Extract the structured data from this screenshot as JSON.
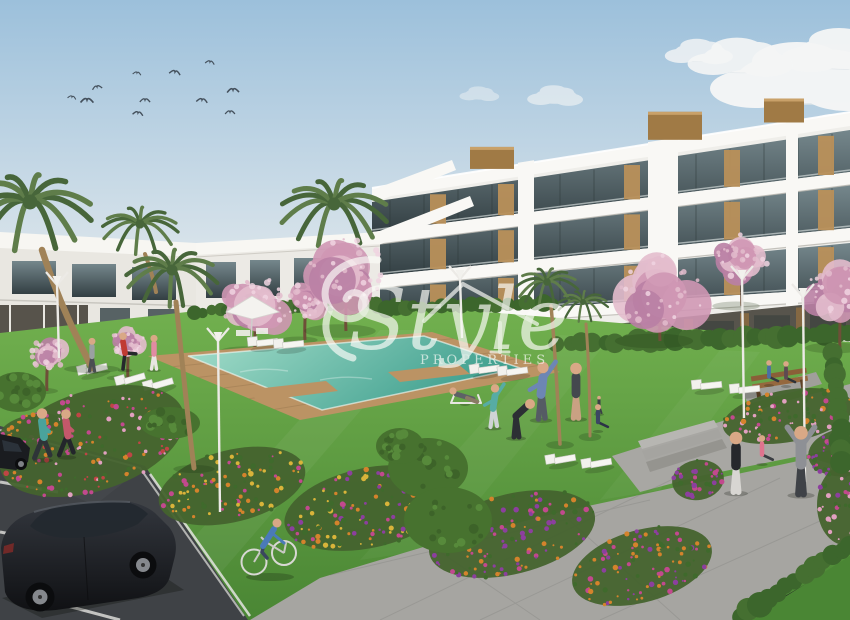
{
  "meta": {
    "kind": "3D architectural render photograph",
    "subject": "New-build residential apartment complex with communal pool, lawns, flower beds and parking"
  },
  "watermark": {
    "brand_script": "Style",
    "brand_sub": "PROPERTIES"
  },
  "colors": {
    "sky_top": "#9cc0db",
    "sky_horizon": "#e4eaed",
    "cloud": "#f5f6f6",
    "wall_white": "#efeeea",
    "wall_bright": "#f9f8f5",
    "wall_shade": "#dddbd4",
    "glass_top": "#75878c",
    "glass_bottom": "#333f43",
    "wood": "#b9905a",
    "wood_dark": "#a07a45",
    "blossom_a": "#cf97b4",
    "blossom_b": "#e3bccd",
    "blossom_c": "#b97fa4",
    "palm_a": "#5f7d4a",
    "palm_b": "#47663a",
    "trunk": "#a08257",
    "lawn": "#72b14f",
    "lawn_dark": "#4a8634",
    "hedge": "#3c662c",
    "bed_base": "#44632e",
    "shrub": "#47722f",
    "flower_orange": "#d4832c",
    "flower_pink": "#c2498e",
    "flower_lightpink": "#e1a0c0",
    "flower_purple": "#8c3f9e",
    "flower_yellow": "#d9b43a",
    "flower_red": "#bf4545",
    "pool_light": "#a5decb",
    "pool_deep": "#3f9f8e",
    "deck": "#bb9364",
    "asphalt": "#3f4246",
    "pavement": "#a6a5a1",
    "pavement_light": "#b5b4b0",
    "line_white": "#e2e2de",
    "car_body": "#17191d",
    "skin": "#d9a886",
    "lamp_white": "#eceae6",
    "watermark": "rgba(251,251,248,0.8)"
  },
  "scene": {
    "birds": [
      [
        210,
        62
      ],
      [
        175,
        72
      ],
      [
        137,
        73
      ],
      [
        97,
        87
      ],
      [
        72,
        97
      ],
      [
        87,
        100
      ],
      [
        145,
        100
      ],
      [
        202,
        100
      ],
      [
        233,
        90
      ],
      [
        138,
        113
      ],
      [
        230,
        112
      ]
    ],
    "clouds": [
      {
        "x": 806,
        "y": 78,
        "s": 1.5,
        "o": 0.97
      },
      {
        "x": 845,
        "y": 52,
        "s": 1.0,
        "o": 0.95
      },
      {
        "x": 742,
        "y": 58,
        "s": 0.85,
        "o": 0.9
      },
      {
        "x": 700,
        "y": 52,
        "s": 0.55,
        "o": 0.8
      },
      {
        "x": 660,
        "y": 173,
        "s": 0.6,
        "o": 0.85
      },
      {
        "x": 722,
        "y": 153,
        "s": 0.45,
        "o": 0.8
      },
      {
        "x": 624,
        "y": 180,
        "s": 0.4,
        "o": 0.75
      },
      {
        "x": 556,
        "y": 96,
        "s": 0.45,
        "o": 0.6
      },
      {
        "x": 838,
        "y": 132,
        "s": 0.75,
        "o": 0.9
      },
      {
        "x": 480,
        "y": 94,
        "s": 0.32,
        "o": 0.45
      }
    ],
    "right_building": {
      "x0": 372,
      "x1": 850,
      "roofL": 188,
      "roofR": 112,
      "bands": [
        {
          "tL": 202,
          "tR": 130,
          "hL": 30,
          "hR": 42
        },
        {
          "tL": 245,
          "tR": 185,
          "hL": 31,
          "hR": 43
        },
        {
          "tL": 289,
          "tR": 243,
          "hL": 29,
          "hR": 45
        }
      ],
      "slabs": [
        {
          "tL": 232,
          "tR": 172,
          "h": 13
        },
        {
          "tL": 276,
          "tR": 228,
          "h": 13
        },
        {
          "tL": 318,
          "tR": 288,
          "h": 12
        }
      ],
      "piers": [
        {
          "x": 518,
          "w": 16
        },
        {
          "x": 648,
          "w": 30
        },
        {
          "x": 786,
          "w": 12
        }
      ],
      "wood": [
        430,
        498,
        624,
        724,
        818
      ],
      "roofBoxes": [
        {
          "x": 470,
          "w": 44,
          "h": 22
        },
        {
          "x": 648,
          "w": 54,
          "h": 28
        },
        {
          "x": 764,
          "w": 40,
          "h": 24
        }
      ]
    },
    "palms_back": [
      {
        "cx": 334,
        "cy": 204,
        "r": 54,
        "trunk": "M 337,246 C 343,268 350,286 353,300",
        "w": 5
      },
      {
        "cx": 140,
        "cy": 224,
        "r": 38,
        "trunk": "M 145,254 C 150,268 154,280 156,292",
        "w": 4
      }
    ],
    "palms_front": [
      {
        "cx": 30,
        "cy": 202,
        "r": 62,
        "trunk": "M 42,250 C 58,300 76,336 92,368",
        "w": 6.5,
        "bx": 92,
        "by": 369
      },
      {
        "cx": 172,
        "cy": 270,
        "r": 46,
        "trunk": "M 176,302 C 182,360 188,422 194,468",
        "w": 5,
        "bx": 194,
        "by": 469
      },
      {
        "cx": 547,
        "cy": 282,
        "r": 31,
        "trunk": "M 551,306 C 556,358 558,408 560,444",
        "w": 3.5,
        "bx": 560,
        "by": 445
      },
      {
        "cx": 583,
        "cy": 302,
        "r": 25,
        "trunk": "M 586,324 C 589,364 590,402 590,436",
        "w": 3,
        "bx": 590,
        "by": 437
      }
    ],
    "blossoms": [
      {
        "cx": 255,
        "cy": 306,
        "r": 36,
        "gy": 352
      },
      {
        "cx": 305,
        "cy": 300,
        "r": 22,
        "gy": 340
      },
      {
        "cx": 346,
        "cy": 271,
        "r": 42,
        "gy": 331
      },
      {
        "cx": 660,
        "cy": 291,
        "r": 46,
        "gy": 341
      },
      {
        "cx": 742,
        "cy": 257,
        "r": 28,
        "gy": 306
      },
      {
        "cx": 840,
        "cy": 291,
        "r": 34,
        "gy": 348
      },
      {
        "cx": 47,
        "cy": 355,
        "r": 20,
        "gy": 391
      },
      {
        "cx": 128,
        "cy": 342,
        "r": 18,
        "gy": 378
      }
    ],
    "hedges": [
      {
        "x1": 196,
        "y1": 312,
        "x2": 378,
        "y2": 302,
        "r": 6,
        "n": 24
      },
      {
        "x1": 376,
        "y1": 308,
        "x2": 554,
        "y2": 303,
        "r": 7,
        "n": 20
      },
      {
        "x1": 558,
        "y1": 344,
        "x2": 848,
        "y2": 334,
        "r": 9,
        "n": 26
      }
    ],
    "hedges2": [
      {
        "x1": 740,
        "y1": 616,
        "x2": 850,
        "y2": 544,
        "r": 10,
        "n": 13
      },
      {
        "x1": 833,
        "y1": 354,
        "x2": 843,
        "y2": 462,
        "r": 9,
        "n": 11
      }
    ],
    "beds": [
      {
        "cx": 92,
        "cy": 441,
        "rx": 96,
        "ry": 50,
        "rot": -18,
        "n": 150,
        "pal": [
          "flower_pink",
          "flower_lightpink",
          "flower_red",
          "flower_orange"
        ]
      },
      {
        "cx": 30,
        "cy": 427,
        "rx": 30,
        "ry": 12,
        "rot": -14,
        "n": 26,
        "pal": [
          "flower_orange",
          "flower_pink"
        ]
      },
      {
        "cx": 232,
        "cy": 486,
        "rx": 75,
        "ry": 36,
        "rot": -14,
        "n": 100,
        "pal": [
          "flower_orange",
          "flower_pink",
          "flower_yellow"
        ]
      },
      {
        "cx": 368,
        "cy": 508,
        "rx": 85,
        "ry": 40,
        "rot": -12,
        "n": 120,
        "pal": [
          "flower_orange",
          "flower_pink",
          "flower_purple",
          "flower_yellow"
        ]
      },
      {
        "cx": 512,
        "cy": 534,
        "rx": 85,
        "ry": 40,
        "rot": -14,
        "n": 120,
        "pal": [
          "flower_pink",
          "flower_orange",
          "flower_purple"
        ]
      },
      {
        "cx": 642,
        "cy": 566,
        "rx": 72,
        "ry": 36,
        "rot": -16,
        "n": 100,
        "pal": [
          "flower_purple",
          "flower_pink",
          "flower_orange"
        ]
      },
      {
        "cx": 788,
        "cy": 416,
        "rx": 66,
        "ry": 26,
        "rot": -10,
        "n": 80,
        "pal": [
          "flower_pink",
          "flower_orange",
          "flower_lightpink"
        ]
      },
      {
        "cx": 846,
        "cy": 452,
        "rx": 38,
        "ry": 24,
        "rot": -8,
        "n": 45,
        "pal": [
          "flower_pink",
          "flower_purple"
        ]
      },
      {
        "cx": 845,
        "cy": 505,
        "rx": 28,
        "ry": 40,
        "rot": 0,
        "n": 45,
        "pal": [
          "flower_lightpink",
          "flower_pink",
          "flower_purple"
        ]
      },
      {
        "cx": 698,
        "cy": 480,
        "rx": 26,
        "ry": 20,
        "rot": -10,
        "n": 30,
        "pal": [
          "flower_pink",
          "flower_purple"
        ]
      }
    ],
    "shrubs": [
      {
        "cx": 428,
        "cy": 468,
        "rx": 40,
        "ry": 30
      },
      {
        "cx": 448,
        "cy": 520,
        "rx": 44,
        "ry": 33
      },
      {
        "cx": 400,
        "cy": 446,
        "rx": 24,
        "ry": 18
      },
      {
        "cx": 18,
        "cy": 392,
        "rx": 28,
        "ry": 20
      },
      {
        "cx": 170,
        "cy": 423,
        "rx": 30,
        "ry": 16
      }
    ],
    "loungers": [
      {
        "x": 92,
        "y": 372,
        "rot": -14
      },
      {
        "x": 130,
        "y": 382,
        "rot": -16
      },
      {
        "x": 158,
        "y": 387,
        "rot": -16
      },
      {
        "x": 262,
        "y": 345,
        "rot": -6
      },
      {
        "x": 288,
        "y": 347,
        "rot": -6
      },
      {
        "x": 484,
        "y": 372,
        "rot": -8
      },
      {
        "x": 512,
        "y": 374,
        "rot": -8
      },
      {
        "x": 560,
        "y": 462,
        "rot": -10
      },
      {
        "x": 596,
        "y": 466,
        "rot": -10
      },
      {
        "x": 706,
        "y": 388,
        "rot": -6
      },
      {
        "x": 744,
        "y": 392,
        "rot": -6
      }
    ],
    "lamps": [
      {
        "x": 57,
        "y": 272,
        "len": 74
      },
      {
        "x": 218,
        "y": 328,
        "len": 172
      },
      {
        "x": 460,
        "y": 266,
        "len": 60
      },
      {
        "x": 742,
        "y": 266,
        "len": 140
      },
      {
        "x": 803,
        "y": 284,
        "len": 186
      }
    ],
    "people": [
      {
        "role": "jogger-1",
        "x": 43,
        "y": 459,
        "h": 50,
        "shirt": "#4aa39b",
        "pants": "#2e3438",
        "pose": "run"
      },
      {
        "role": "jogger-2",
        "x": 67,
        "y": 456,
        "h": 46,
        "shirt": "#c4586b",
        "pants": "#23262b",
        "pose": "run"
      },
      {
        "role": "pool-walker",
        "x": 92,
        "y": 371,
        "h": 33,
        "shirt": "#9aa0a2",
        "pants": "#4a4e52",
        "pose": "stand"
      },
      {
        "role": "pool-exerciser",
        "x": 125,
        "y": 369,
        "h": 36,
        "shirt": "#c03a33",
        "pants": "#26282c",
        "pose": "kick"
      },
      {
        "role": "pool-woman",
        "x": 154,
        "y": 369,
        "h": 34,
        "shirt": "#e18ba2",
        "pants": "#e8e6e2",
        "pose": "stand"
      },
      {
        "role": "sunbather",
        "x": 465,
        "y": 403,
        "h": 24,
        "shirt": "#5d6166",
        "pants": "#8a7a65",
        "pose": "lie"
      },
      {
        "role": "yoga-woman",
        "x": 493,
        "y": 427,
        "h": 42,
        "shirt": "#57aca4",
        "pants": "#cfd4d6",
        "pose": "stretch"
      },
      {
        "role": "exerciser-bending",
        "x": 516,
        "y": 437,
        "h": 50,
        "shirt": "#2c2f34",
        "pants": "#2c2f34",
        "pose": "bend"
      },
      {
        "role": "exerciser-stretching",
        "x": 541,
        "y": 419,
        "h": 56,
        "shirt": "#6d86b4",
        "pants": "#555b64",
        "pose": "stretch"
      },
      {
        "role": "exerciser-shorts",
        "x": 576,
        "y": 418,
        "h": 55,
        "shirt": "#44484e",
        "pants": "#c9a183",
        "pose": "stand"
      },
      {
        "role": "child",
        "x": 599,
        "y": 413,
        "h": 17,
        "shirt": "#3a3f46",
        "pants": "#3a3f46",
        "pose": "stand"
      },
      {
        "role": "seated-meditator",
        "x": 598,
        "y": 430,
        "h": 26,
        "shirt": "#3c4663",
        "pants": "#2c3246",
        "pose": "sit"
      },
      {
        "role": "walker-woman",
        "x": 736,
        "y": 492,
        "h": 60,
        "shirt": "#26282c",
        "pants": "#d8d6d2",
        "pose": "stand"
      },
      {
        "role": "seated-woman",
        "x": 762,
        "y": 463,
        "h": 28,
        "shirt": "#e0738e",
        "pants": "#3a3d42",
        "pose": "sit"
      },
      {
        "role": "exerciser-armsup",
        "x": 801,
        "y": 494,
        "h": 68,
        "shirt": "#8e9095",
        "pants": "#3f4247",
        "pose": "armsup"
      },
      {
        "role": "bench-sitter-1",
        "x": 769,
        "y": 384,
        "h": 24,
        "shirt": "#4a6fa5",
        "pants": "#343841",
        "pose": "sit"
      },
      {
        "role": "bench-sitter-2",
        "x": 786,
        "y": 385,
        "h": 24,
        "shirt": "#5d4a52",
        "pants": "#2e3238",
        "pose": "sit"
      }
    ]
  }
}
